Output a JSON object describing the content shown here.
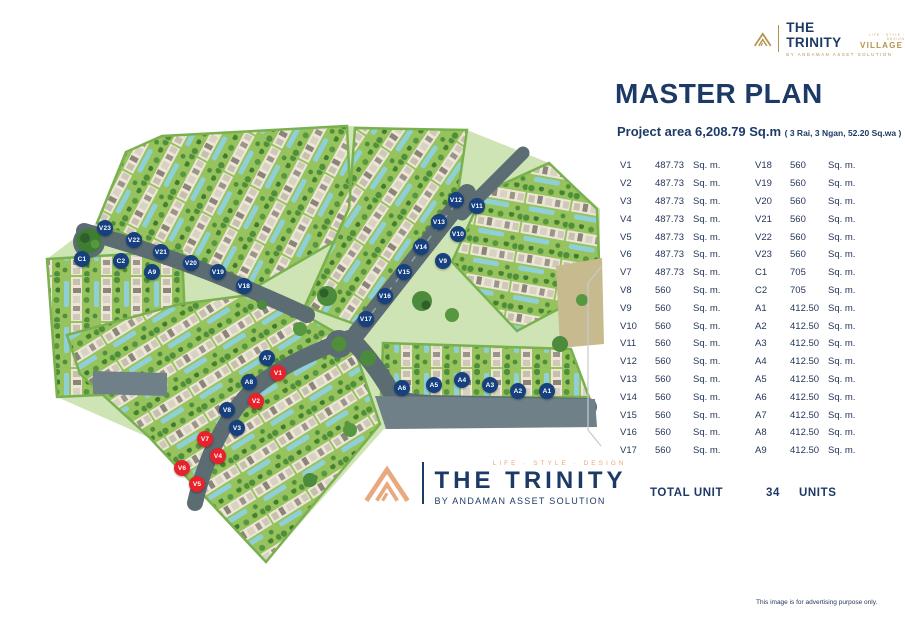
{
  "brand": {
    "top_logo": {
      "name": "THE TRINITY",
      "suffix": "VILLAGE",
      "tagline": "LIFE · STYLE · DESIGN",
      "byline": "BY ANDAMAN ASSET SOLUTION"
    },
    "bottom_logo": {
      "tagline": "LIFE · STYLE · DESIGN",
      "name": "THE TRINITY",
      "byline": "BY ANDAMAN ASSET SOLUTION"
    }
  },
  "header": {
    "title": "MASTER PLAN",
    "project_area": "Project area 6,208.79 Sq.m ",
    "project_area_detail": "( 3 Rai, 3 Ngan, 52.20 Sq.wa )"
  },
  "unit_table": {
    "left": [
      {
        "id": "V1",
        "area": "487.73",
        "suffix": "Sq. m."
      },
      {
        "id": "V2",
        "area": "487.73",
        "suffix": "Sq. m."
      },
      {
        "id": "V3",
        "area": "487.73",
        "suffix": "Sq. m."
      },
      {
        "id": "V4",
        "area": "487.73",
        "suffix": "Sq. m."
      },
      {
        "id": "V5",
        "area": "487.73",
        "suffix": "Sq. m."
      },
      {
        "id": "V6",
        "area": "487.73",
        "suffix": "Sq. m."
      },
      {
        "id": "V7",
        "area": "487.73",
        "suffix": "Sq. m."
      },
      {
        "id": "V8",
        "area": "560",
        "suffix": "Sq. m."
      },
      {
        "id": "V9",
        "area": "560",
        "suffix": "Sq. m."
      },
      {
        "id": "V10",
        "area": "560",
        "suffix": "Sq. m."
      },
      {
        "id": "V11",
        "area": "560",
        "suffix": "Sq. m."
      },
      {
        "id": "V12",
        "area": "560",
        "suffix": "Sq. m."
      },
      {
        "id": "V13",
        "area": "560",
        "suffix": "Sq. m."
      },
      {
        "id": "V14",
        "area": "560",
        "suffix": "Sq. m."
      },
      {
        "id": "V15",
        "area": "560",
        "suffix": "Sq. m."
      },
      {
        "id": "V16",
        "area": "560",
        "suffix": "Sq. m."
      },
      {
        "id": "V17",
        "area": "560",
        "suffix": "Sq. m."
      }
    ],
    "right": [
      {
        "id": "V18",
        "area": "560",
        "suffix": "Sq. m."
      },
      {
        "id": "V19",
        "area": "560",
        "suffix": "Sq. m."
      },
      {
        "id": "V20",
        "area": "560",
        "suffix": "Sq. m."
      },
      {
        "id": "V21",
        "area": "560",
        "suffix": "Sq. m."
      },
      {
        "id": "V22",
        "area": "560",
        "suffix": "Sq. m."
      },
      {
        "id": "V23",
        "area": "560",
        "suffix": "Sq. m."
      },
      {
        "id": "C1",
        "area": "705",
        "suffix": "Sq. m."
      },
      {
        "id": "C2",
        "area": "705",
        "suffix": "Sq. m."
      },
      {
        "id": "A1",
        "area": "412.50",
        "suffix": "Sq. m."
      },
      {
        "id": "A2",
        "area": "412.50",
        "suffix": "Sq. m."
      },
      {
        "id": "A3",
        "area": "412.50",
        "suffix": "Sq. m."
      },
      {
        "id": "A4",
        "area": "412.50",
        "suffix": "Sq. m."
      },
      {
        "id": "A5",
        "area": "412.50",
        "suffix": "Sq. m."
      },
      {
        "id": "A6",
        "area": "412.50",
        "suffix": "Sq. m."
      },
      {
        "id": "A7",
        "area": "412.50",
        "suffix": "Sq. m."
      },
      {
        "id": "A8",
        "area": "412.50",
        "suffix": "Sq. m."
      },
      {
        "id": "A9",
        "area": "412.50",
        "suffix": "Sq. m."
      }
    ],
    "total_label": "TOTAL UNIT",
    "total_value": "34",
    "total_units_label": "UNITS"
  },
  "map": {
    "markers": [
      {
        "id": "V23",
        "x": 105,
        "y": 228,
        "type": "blue"
      },
      {
        "id": "V22",
        "x": 134,
        "y": 240,
        "type": "blue"
      },
      {
        "id": "V21",
        "x": 161,
        "y": 252,
        "type": "blue"
      },
      {
        "id": "C1",
        "x": 82,
        "y": 259,
        "type": "blue"
      },
      {
        "id": "C2",
        "x": 121,
        "y": 261,
        "type": "blue"
      },
      {
        "id": "A9",
        "x": 152,
        "y": 272,
        "type": "blue"
      },
      {
        "id": "V20",
        "x": 191,
        "y": 263,
        "type": "blue"
      },
      {
        "id": "V19",
        "x": 218,
        "y": 272,
        "type": "blue"
      },
      {
        "id": "V18",
        "x": 244,
        "y": 286,
        "type": "blue"
      },
      {
        "id": "V12",
        "x": 456,
        "y": 200,
        "type": "blue"
      },
      {
        "id": "V11",
        "x": 477,
        "y": 206,
        "type": "blue"
      },
      {
        "id": "V13",
        "x": 439,
        "y": 222,
        "type": "blue"
      },
      {
        "id": "V10",
        "x": 458,
        "y": 234,
        "type": "blue"
      },
      {
        "id": "V14",
        "x": 421,
        "y": 247,
        "type": "blue"
      },
      {
        "id": "V9",
        "x": 443,
        "y": 261,
        "type": "blue"
      },
      {
        "id": "V15",
        "x": 404,
        "y": 272,
        "type": "blue"
      },
      {
        "id": "V16",
        "x": 385,
        "y": 296,
        "type": "blue"
      },
      {
        "id": "V17",
        "x": 366,
        "y": 319,
        "type": "blue"
      },
      {
        "id": "A7",
        "x": 267,
        "y": 358,
        "type": "blue"
      },
      {
        "id": "V1",
        "x": 278,
        "y": 373,
        "type": "red"
      },
      {
        "id": "A8",
        "x": 249,
        "y": 382,
        "type": "blue"
      },
      {
        "id": "V2",
        "x": 256,
        "y": 401,
        "type": "red"
      },
      {
        "id": "V8",
        "x": 227,
        "y": 410,
        "type": "blue"
      },
      {
        "id": "V3",
        "x": 237,
        "y": 428,
        "type": "blue"
      },
      {
        "id": "V7",
        "x": 205,
        "y": 439,
        "type": "red"
      },
      {
        "id": "V4",
        "x": 218,
        "y": 456,
        "type": "red"
      },
      {
        "id": "V6",
        "x": 182,
        "y": 468,
        "type": "red"
      },
      {
        "id": "V5",
        "x": 197,
        "y": 484,
        "type": "red"
      },
      {
        "id": "A6",
        "x": 402,
        "y": 388,
        "type": "blue"
      },
      {
        "id": "A5",
        "x": 434,
        "y": 385,
        "type": "blue"
      },
      {
        "id": "A4",
        "x": 462,
        "y": 380,
        "type": "blue"
      },
      {
        "id": "A3",
        "x": 490,
        "y": 385,
        "type": "blue"
      },
      {
        "id": "A2",
        "x": 518,
        "y": 391,
        "type": "blue"
      },
      {
        "id": "A1",
        "x": 547,
        "y": 391,
        "type": "blue"
      }
    ]
  },
  "footer": {
    "disclaimer": "This image is for advertising purpose only."
  },
  "colors": {
    "navy": "#1d3a66",
    "gold": "#b3924c",
    "orange": "#e9a97e",
    "marker_blue": "#16407e",
    "marker_red": "#e8222c"
  }
}
